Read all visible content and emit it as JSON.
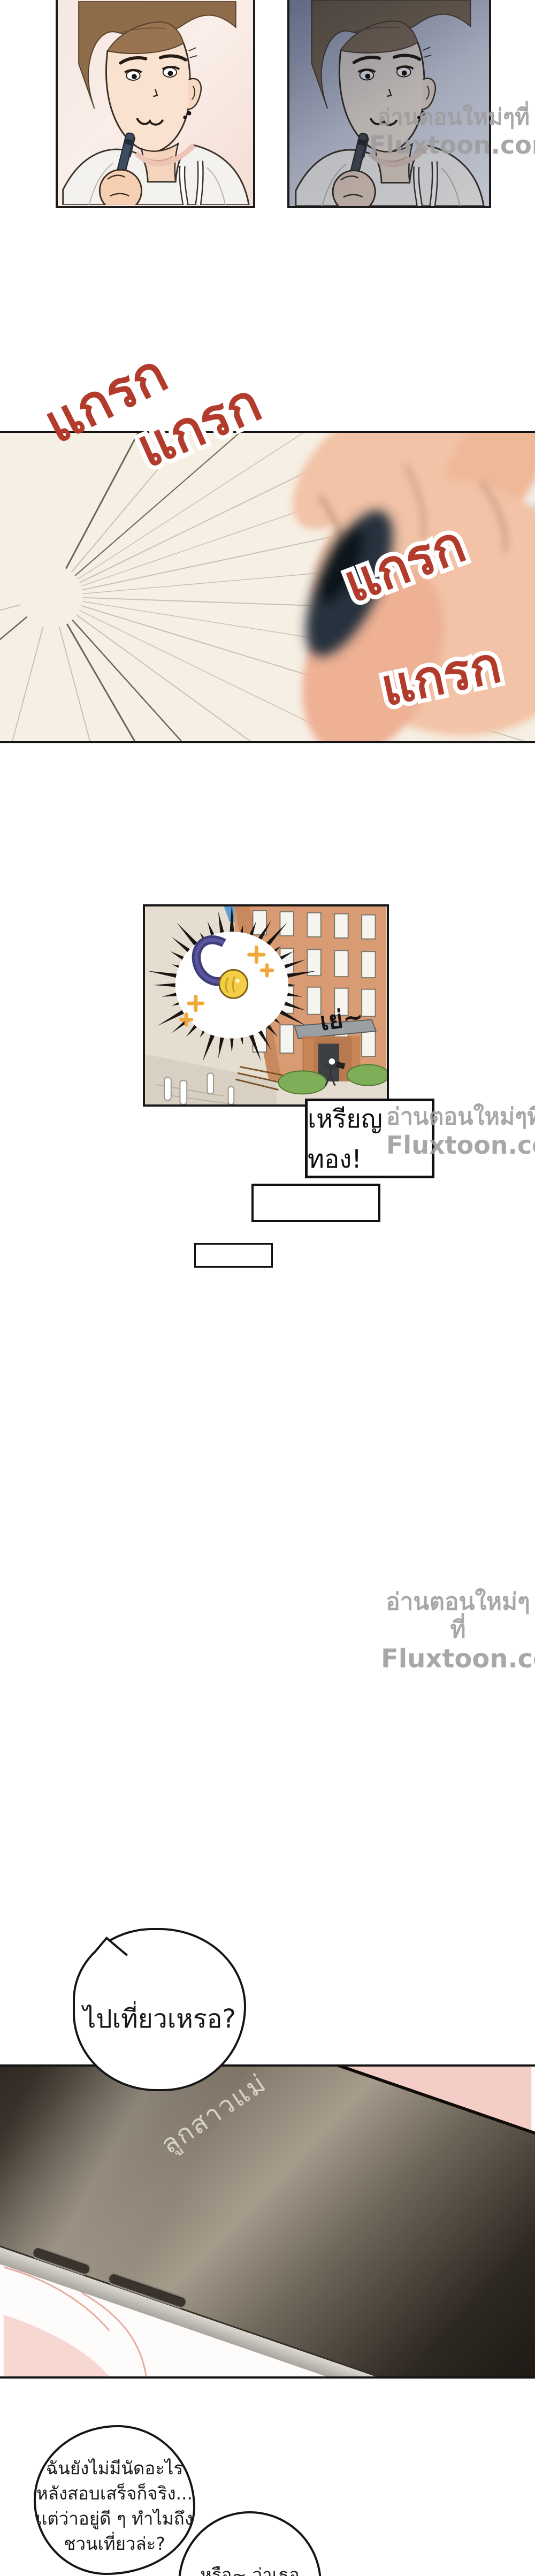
{
  "page": {
    "kind": "webtoon-comic-page",
    "language": "th"
  },
  "watermark": {
    "line1": "อ่านตอนใหม่ๆที่",
    "line2": "Fluxtoon.com"
  },
  "sfx": {
    "text": "แกรก"
  },
  "big_panel": {
    "handwriting_line1": "สวัสดีครับอาจารย์",
    "handwriting_line2": "ผมชื่อดีแทวอน รหัส**",
    "faint_handwriting": "บสนุนในวั"
  },
  "medal_panel": {
    "cheer_text": "เย่~"
  },
  "caption_box": {
    "text": "เหรียญทอง!"
  },
  "speech_bubbles": {
    "travel_question": "ไปเที่ยวเหรอ?",
    "reply_lines": [
      "ฉันยังไม่มีนัดอะไร",
      "หลังสอบเสร็จก็จริง...",
      "แต่ว่าอยู่ดี ๆ ทำไมถึง",
      "ชวนเที่ยวล่ะ?"
    ],
    "or_text": "หรือ~ ว่าเธอ"
  },
  "phone": {
    "caller_name": "ลูกสาวแม่"
  },
  "colors": {
    "sfx_red": "#b23b2c",
    "watermark_gray": "#9d9d9d",
    "panel_cream": "#f6efe4",
    "medal_gold": "#f2cf45",
    "ribbon_navy": "#403d79",
    "sparkle_orange": "#f0a838",
    "brick": "#d99b74",
    "bedding_pink": "#f3cdc6",
    "phone_dark": "#17120e"
  }
}
